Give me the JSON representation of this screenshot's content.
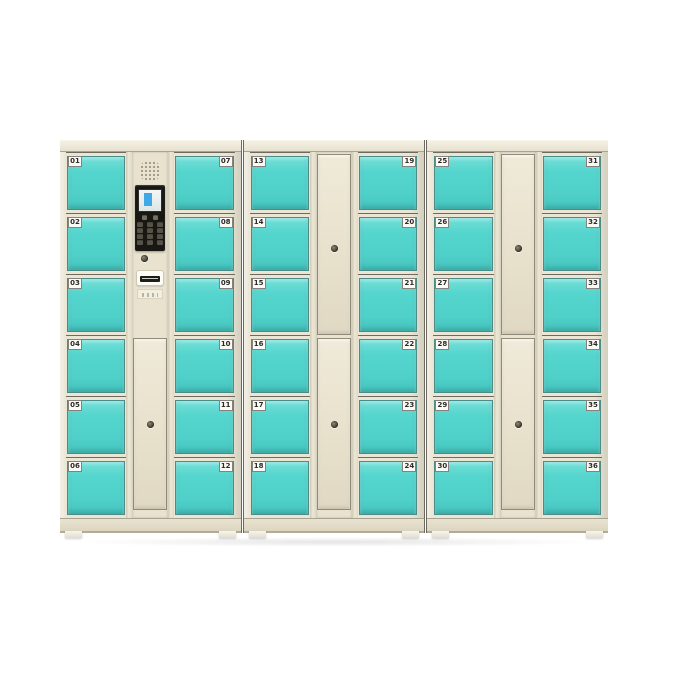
{
  "colors": {
    "door_teal": "#54d5cd",
    "cabinet_cream": "#eae5d4",
    "mid_column_cream": "#e8e2cf",
    "panel_black": "#181712",
    "screen_blue": "#3fa8e8",
    "number_label_bg": "#fbfaf5",
    "number_label_text": "#2b2b2b",
    "background": "#ffffff"
  },
  "lockers": {
    "cabinets": [
      {
        "id": "cabinet-1",
        "left_door_numbers": [
          "01",
          "02",
          "03",
          "04",
          "05",
          "06"
        ],
        "right_door_numbers": [
          "07",
          "08",
          "09",
          "10",
          "11",
          "12"
        ],
        "center": {
          "type": "control-column",
          "components": [
            "speaker-grille",
            "display-screen",
            "function-keys",
            "numeric-keypad",
            "keyhole",
            "receipt-slot",
            "info-sticker"
          ],
          "lower_door": {
            "keyhole": true
          }
        }
      },
      {
        "id": "cabinet-2",
        "left_door_numbers": [
          "13",
          "14",
          "15",
          "16",
          "17",
          "18"
        ],
        "right_door_numbers": [
          "19",
          "20",
          "21",
          "22",
          "23",
          "24"
        ],
        "center": {
          "type": "door-column",
          "doors": [
            {
              "keyhole": true
            },
            {
              "keyhole": true
            }
          ]
        }
      },
      {
        "id": "cabinet-3",
        "left_door_numbers": [
          "25",
          "26",
          "27",
          "28",
          "29",
          "30"
        ],
        "right_door_numbers": [
          "31",
          "32",
          "33",
          "34",
          "35",
          "36"
        ],
        "center": {
          "type": "door-column",
          "doors": [
            {
              "keyhole": true
            },
            {
              "keyhole": true
            }
          ]
        }
      }
    ]
  }
}
